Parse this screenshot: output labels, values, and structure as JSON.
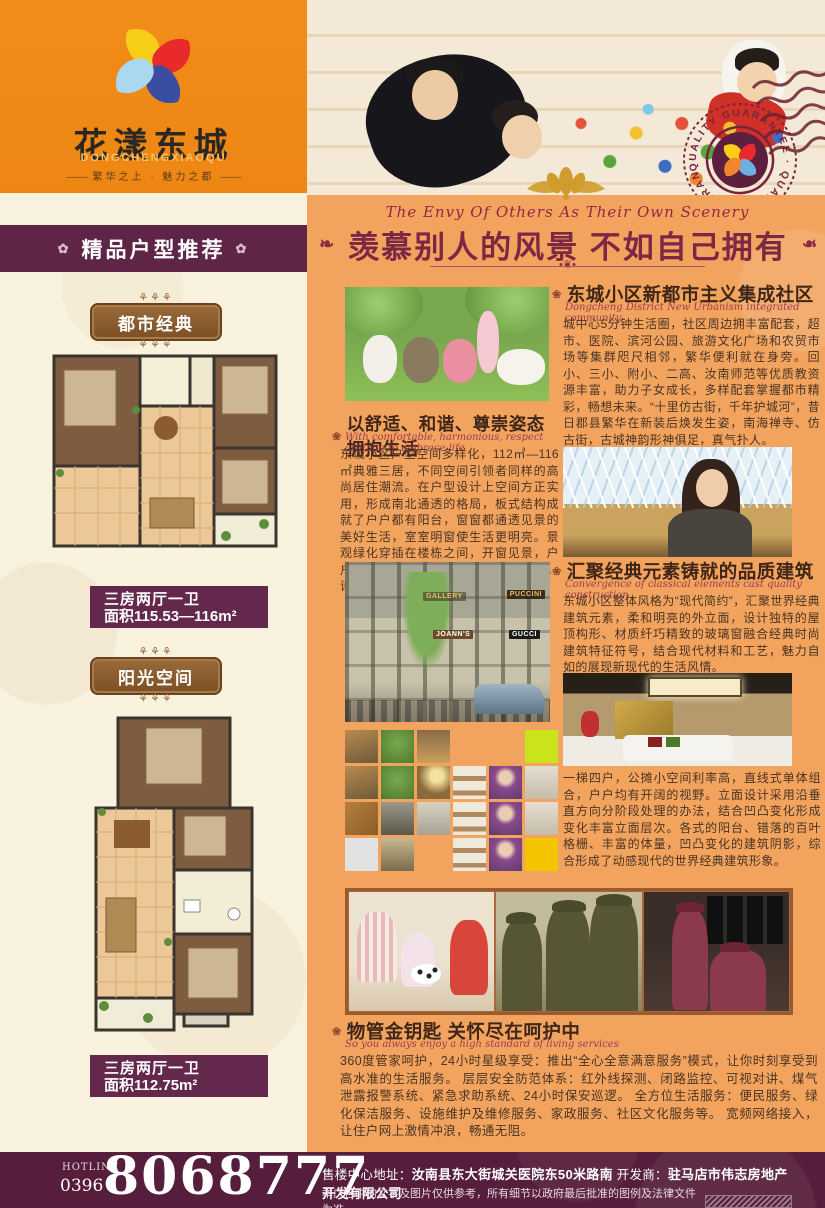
{
  "colors": {
    "header_orange": "#ee8614",
    "panel_orange": "#f2a45f",
    "cream": "#f9f2df",
    "banner_purple": "#5e2547",
    "caption_purple": "#63284b",
    "badge_brown": "#8a5c31",
    "title_maroon": "#7c2743",
    "footer_purple": "#561e3c",
    "accent_gold": "#c9912b",
    "collage_lime": "#cbe31a",
    "collage_amber": "#f5c400"
  },
  "icons": {
    "flower": "✿",
    "bullet": "❀",
    "ornament": "❧",
    "divider": "•❦•",
    "tagline_dash": "—·—"
  },
  "logo": {
    "title": "花漾东城",
    "subtitle": "DONGCHENGXIAOQU",
    "tagline": "繁华之上 · 魅力之都"
  },
  "stamp": {
    "text": "QUALITY GUARANTEE · QUALITY GUARANTEE ·"
  },
  "left_panel": {
    "header": "精品户型推荐",
    "plans": [
      {
        "badge": "都市经典",
        "caption_rooms": "三房两厅一卫",
        "caption_area": "面积115.53—116m²"
      },
      {
        "badge": "阳光空间",
        "caption_rooms": "三房两厅一卫",
        "caption_area": "面积112.75m²"
      }
    ]
  },
  "hero": {
    "title_en": "The Envy Of Others As Their Own Scenery",
    "title": "羡慕别人的风景 不如自己拥有"
  },
  "sections": {
    "community": {
      "heading": "东城小区新都市主义集成社区",
      "heading_en": "Dongcheng District New Urbanism integrated community",
      "body": "城中心5分钟生活圈，社区周边拥丰富配套，超市、医院、滨河公园、旅游文化广场和农贸市场等集群咫尺相邻，繁华便利就在身旁。回小、三小、附小、二高、汝南师范等优质教资源丰富，助力子女成长，多样配套掌握都市精彩，畅想未来。“十里仿古街，千年护城河”，昔日郡县繁华在新装后焕发生姿，南海禅寺、仿古街，古城神韵形神俱足，真气扑人。"
    },
    "comfort": {
      "heading": "以舒适、和谐、尊崇姿态拥抱生活",
      "heading_en": "With comfortable, harmonious, respect attitude to embrace life",
      "body": "东城小区户型空间多样化，112㎡—116㎡典雅三居，不同空间引领者同样的高尚居住潮流。在户型设计上空间方正实用，形成南北通透的格局，板式结构成就了户户都有阳台，窗窗都通透见景的美好生活，室室明窗使生活更明亮。景观绿化穿插在楼栋之间，开窗见景，户户见景。河景楼盘更使观景惬意自在，诗意生活即可呈现。"
    },
    "quality": {
      "heading": "汇聚经典元素铸就的品质建筑",
      "heading_en": "Convergence of classical elements cast quality construction",
      "body": "东城小区整体风格为“现代简约”，汇聚世界经典建筑元素，柔和明亮的外立面，设计独特的屋顶构形、材质纤巧精致的玻璃窗融合经典时尚建筑特征符号，结合现代材料和工艺，魅力自如的展现新现代的生活风情。",
      "body2": "一梯四户，公摊小空间利率高，直线式单体组合，户户均有开阔的视野。立面设计采用沿垂直方向分阶段处理的办法，结合凹凸变化形成变化丰富立面层次。各式的阳台、错落的百叶格栅、丰富的体量，凹凸变化的建筑阴影，综合形成了动感现代的世界经典建筑形象。"
    },
    "service": {
      "heading": "物管金钥匙 关怀尽在呵护中",
      "heading_en": "So you always enjoy a high standard of living services",
      "body": "360度管家呵护，24小时星级享受：推出“全心全意满意服务”模式，让你时刻享受到高水准的生活服务。 层层安全防范体系：红外线探测、闭路监控、可视对讲、煤气泄露报警系统、紧急求助系统、24小时保安巡逻。 全方位生活服务：便民服务、绿化保洁服务、设施维护及维修服务、家政服务、社区文化服务等。 宽频网络接入，让住户网上激情冲浪，畅通无阻。"
    }
  },
  "photos": {
    "street_signs": [
      "GALLERY",
      "PUCCINI",
      "JOANN'S",
      "GUCCI"
    ]
  },
  "collage": {
    "tiles": [
      "street",
      "tree",
      "shop",
      "bg",
      "bg",
      "lime",
      "street",
      "tree",
      "lamp",
      "shoes",
      "model",
      "shelf",
      "wood",
      "people",
      "window",
      "shoes",
      "model",
      "shelf",
      "gray",
      "store",
      "bg",
      "shoes",
      "model",
      "amber"
    ]
  },
  "footer": {
    "hotline_label": "HOTLINE",
    "hotline_code": "0396",
    "hotline_number": "8068777",
    "address_label": "售楼中心地址：",
    "address": "汝南县东大街城关医院东50米路南",
    "developer_label": "开发商：",
    "developer": "驻马店市伟志房地产开发有限公司",
    "disclaimer": "本广告中的文字及图片仅供参考，所有细节以政府最后批准的图例及法律文件为准。"
  }
}
